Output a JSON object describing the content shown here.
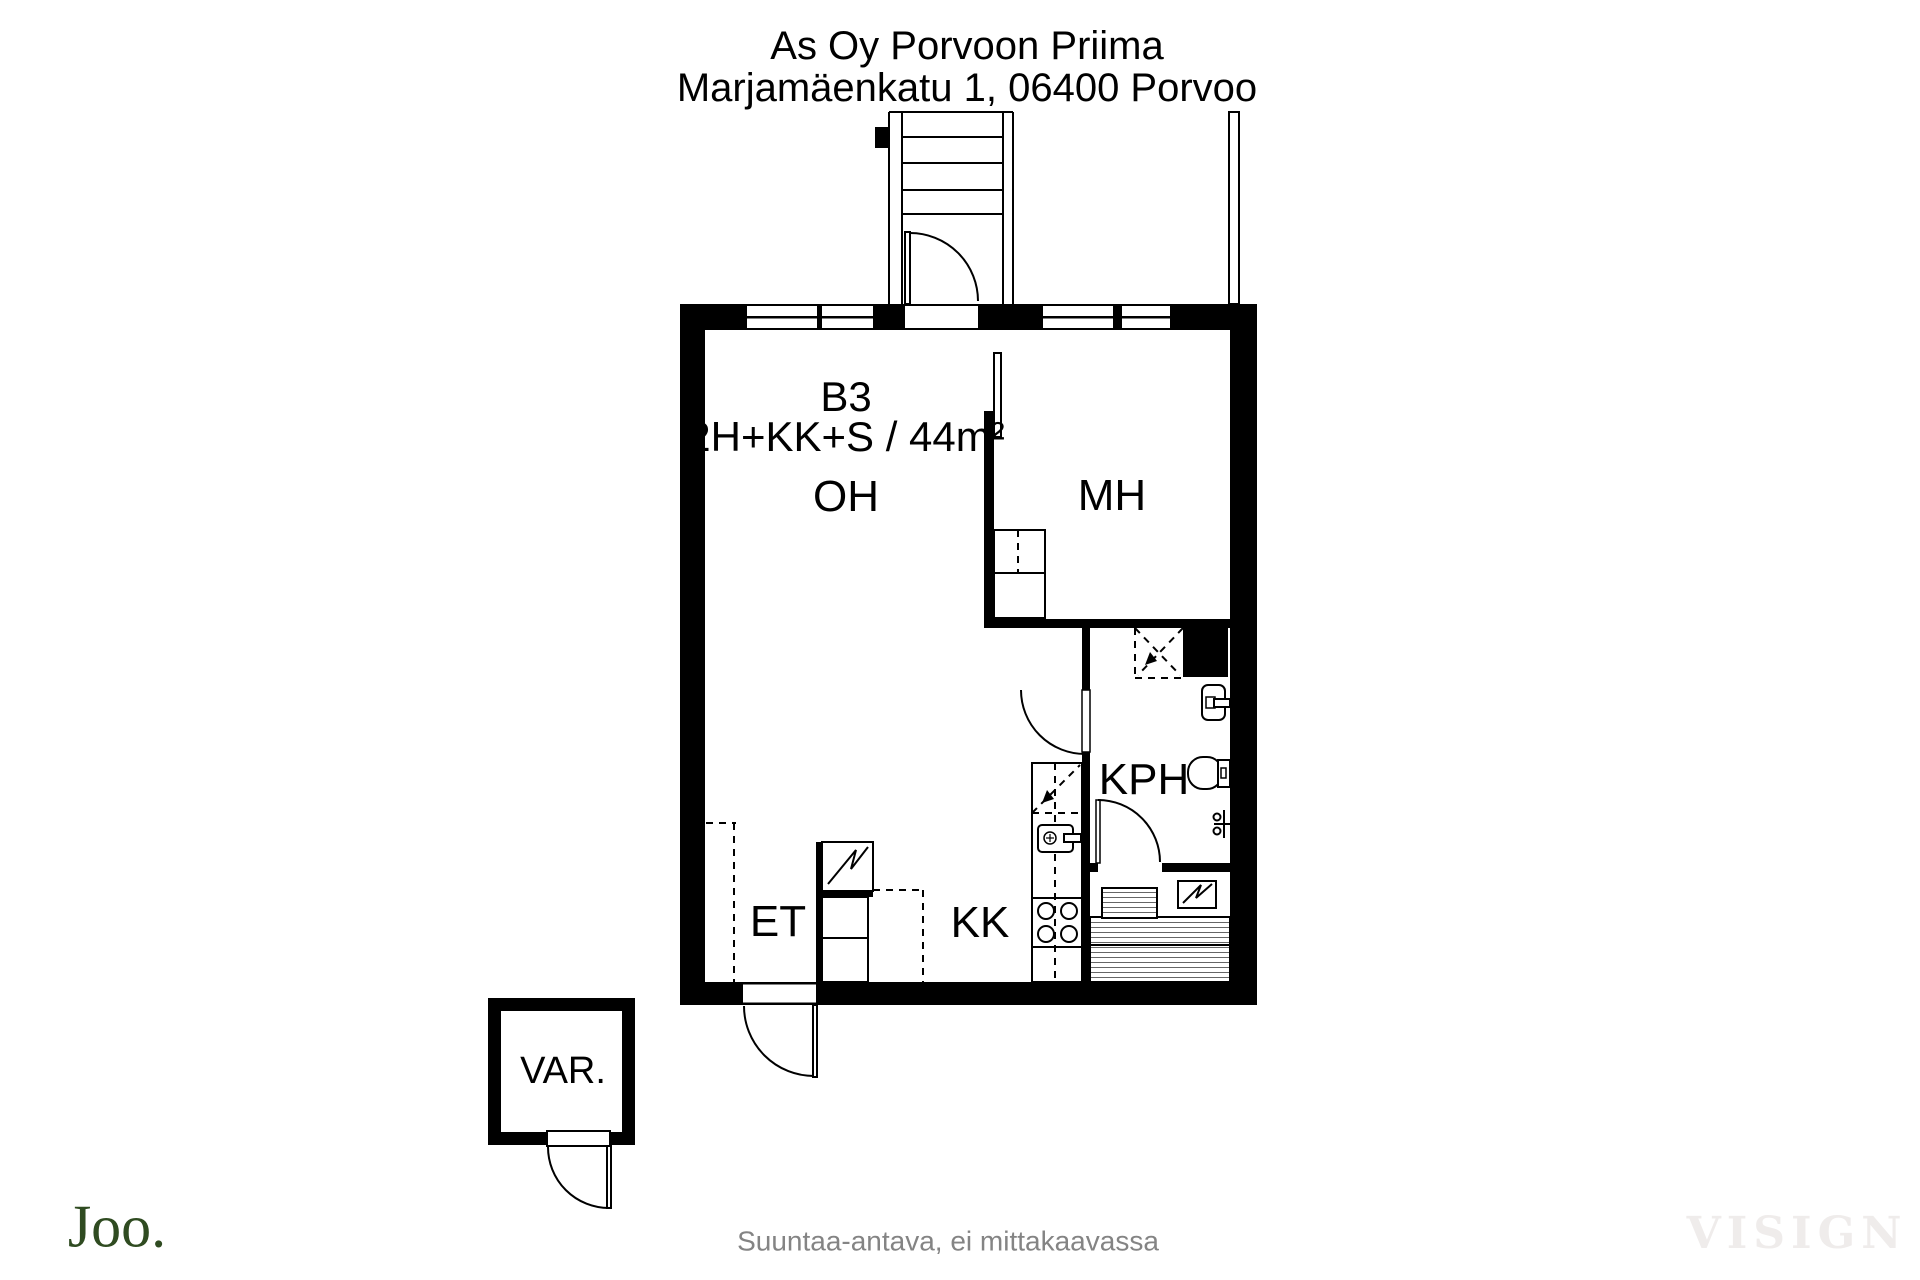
{
  "header": {
    "building_name": "As Oy Porvoon Priima",
    "address": "Marjamäenkatu 1, 06400 Porvoo"
  },
  "apartment": {
    "unit_id": "B3",
    "unit_type": "2H+KK+S / 44m²"
  },
  "rooms": {
    "living_room": "OH",
    "bedroom": "MH",
    "bathroom": "KPH",
    "entry": "ET",
    "kitchenette": "KK",
    "storage": "VAR."
  },
  "footer": {
    "disclaimer": "Suuntaa-antava, ei mittakaavassa",
    "brand": "Joo.",
    "watermark": "VISIGN"
  },
  "colors": {
    "wall": "#000000",
    "brand_green": "#2f4b21",
    "watermark_gray": "#efeceb",
    "disclaimer_gray": "#848484"
  }
}
